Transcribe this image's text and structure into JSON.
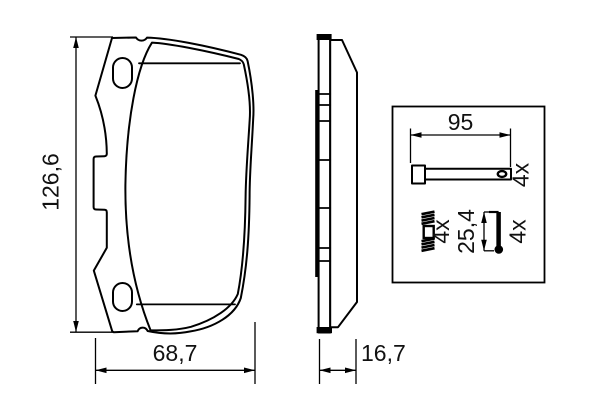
{
  "colors": {
    "background": "#ffffff",
    "line": "#000000",
    "text": "#111111"
  },
  "front_view": {
    "height_label": "126,6",
    "width_label": "68,7"
  },
  "side_view": {
    "thickness_label": "16,7"
  },
  "hardware_kit": {
    "pin": {
      "length_label": "95",
      "quantity_label": "4x"
    },
    "spring": {
      "quantity_label": "4x"
    },
    "clip": {
      "height_label": "25,4",
      "quantity_label": "4x"
    }
  }
}
